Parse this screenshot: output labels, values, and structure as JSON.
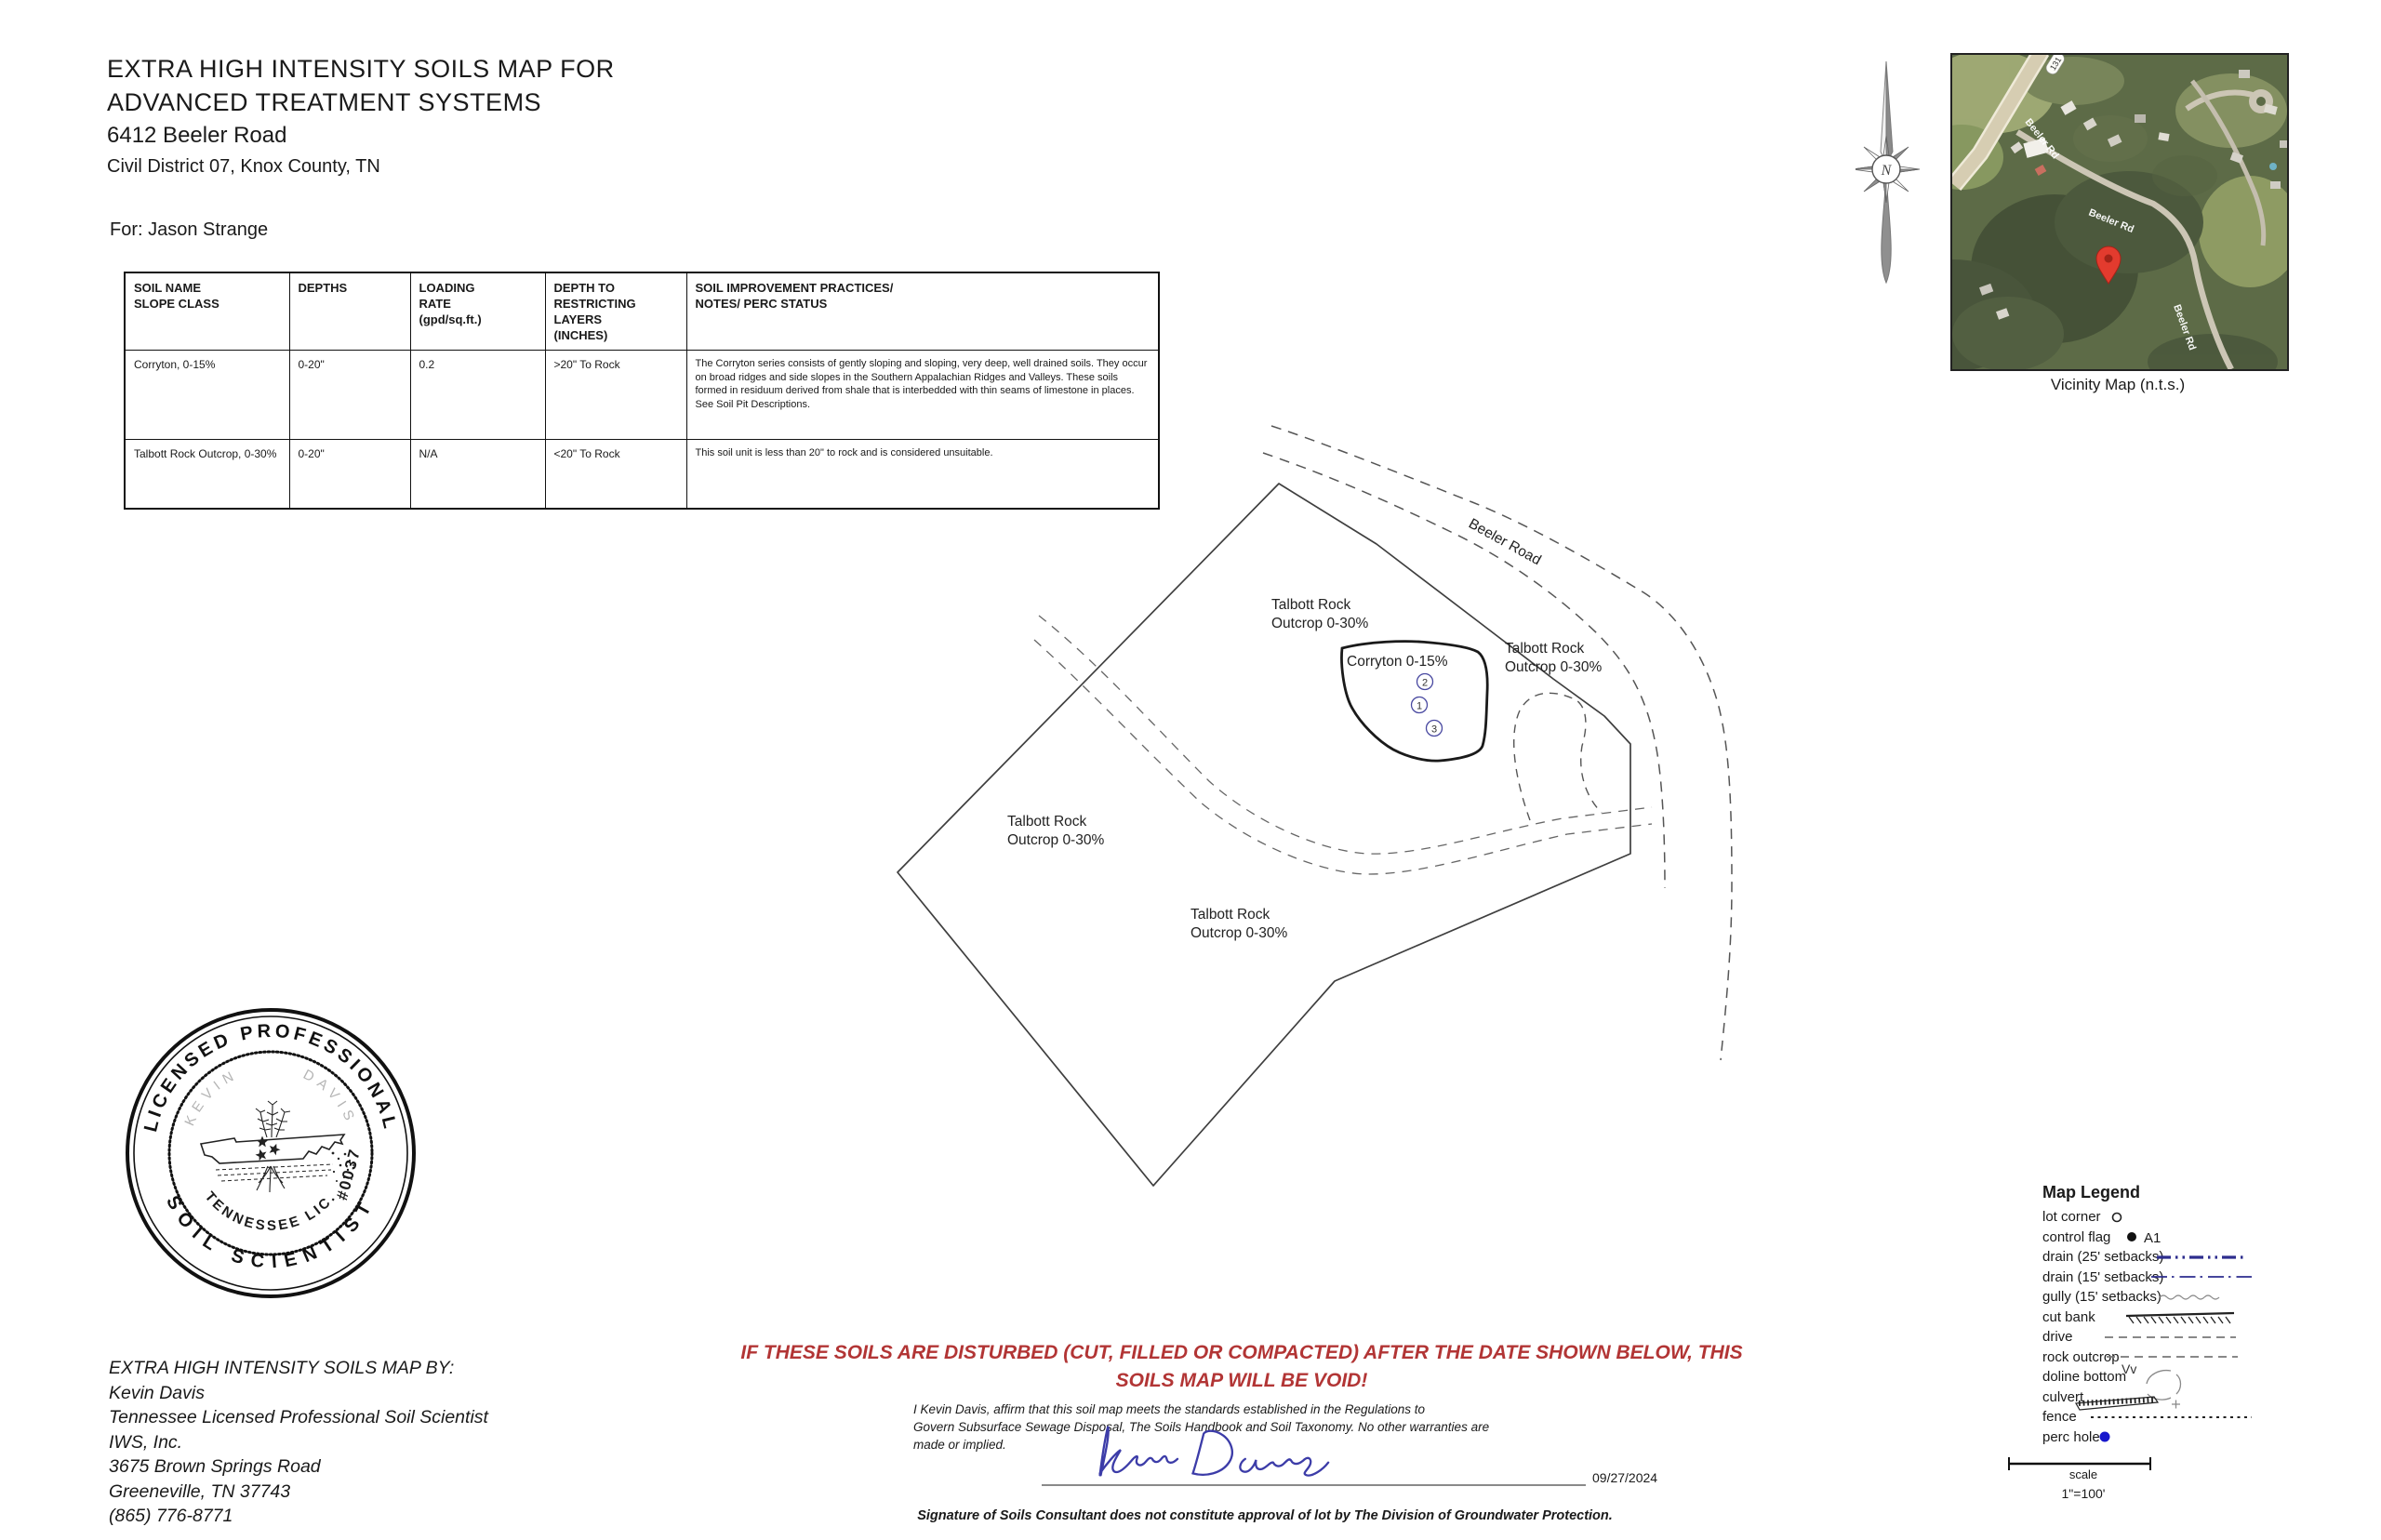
{
  "title": {
    "line1": "EXTRA HIGH INTENSITY SOILS MAP FOR",
    "line2": "ADVANCED TREATMENT SYSTEMS",
    "line3": "6412 Beeler Road",
    "line4": "Civil District 07, Knox County, TN",
    "for_line": "For:  Jason Strange"
  },
  "soil_table": {
    "headers": {
      "col1": [
        "SOIL NAME",
        "SLOPE CLASS"
      ],
      "col2": [
        "DEPTHS"
      ],
      "col3": [
        "LOADING",
        "RATE",
        "(gpd/sq.ft.)"
      ],
      "col4": [
        "DEPTH TO",
        "RESTRICTING",
        "LAYERS",
        "(INCHES)"
      ],
      "col5": [
        "SOIL IMPROVEMENT PRACTICES/",
        "NOTES/ PERC STATUS"
      ]
    },
    "rows": [
      {
        "name": "Corryton, 0-15%",
        "depths": "0-20\"",
        "rate": "0.2",
        "restricting": ">20\" To Rock",
        "notes": "The Corryton series consists of gently sloping and sloping, very deep, well drained soils. They occur on broad ridges and side slopes in the Southern Appalachian Ridges and Valleys. These soils formed in residuum derived from shale that is interbedded with thin seams of limestone in places. See Soil Pit Descriptions."
      },
      {
        "name": "Talbott Rock Outcrop, 0-30%",
        "depths": "0-20\"",
        "rate": "N/A",
        "restricting": "<20\" To Rock",
        "notes": "This soil unit is less than 20\" to rock and is considered unsuitable."
      }
    ]
  },
  "map": {
    "road_label": "Beeler Road",
    "corryton_label": "Corryton 0-15%",
    "talbott_line1": "Talbott Rock",
    "talbott_line2": "Outcrop 0-30%",
    "perc1": "2",
    "perc2": "1",
    "perc3": "3"
  },
  "vicinity": {
    "caption": "Vicinity Map (n.t.s.)",
    "road_label": "Beeler Rd",
    "route_shield": "131"
  },
  "compass": {
    "letter": "N"
  },
  "seal": {
    "arc_top": "LICENSED PROFESSIONAL",
    "arc_bottom": "SOIL SCIENTIST",
    "inner_left": "KEVIN",
    "inner_right": "DAVIS",
    "inner_bottom": "TENNESSEE LIC.",
    "license": "#0037"
  },
  "author_block": {
    "line1": "EXTRA HIGH INTENSITY SOILS MAP BY:",
    "line2": "Kevin Davis",
    "line3": "Tennessee Licensed Professional Soil Scientist",
    "line4": "IWS, Inc.",
    "line5": "3675 Brown Springs Road",
    "line6": "Greeneville, TN 37743",
    "line7": "(865)  776-8771"
  },
  "warning": {
    "line1": "IF THESE SOILS ARE DISTURBED (CUT, FILLED OR COMPACTED) AFTER THE DATE SHOWN BELOW, THIS",
    "line2": "SOILS MAP WILL BE VOID!"
  },
  "affirmation": {
    "line1": "I Kevin Davis, affirm that this soil map meets the standards established in the Regulations to",
    "line2": "Govern Subsurface Sewage Disposal, The Soils Handbook and Soil Taxonomy.  No other warranties are",
    "line3": "made or implied.",
    "signature_name": "Kevin Davis",
    "date": "09/27/2024",
    "disclaimer": "Signature of Soils Consultant does not constitute approval of lot by The Division of Groundwater Protection."
  },
  "legend": {
    "title": "Map Legend",
    "items": [
      {
        "label": "lot corner"
      },
      {
        "label": "control flag"
      },
      {
        "label": "drain (25' setbacks)"
      },
      {
        "label": "drain (15' setbacks)"
      },
      {
        "label": "gully  (15' setbacks)"
      },
      {
        "label": "cut bank"
      },
      {
        "label": "drive"
      },
      {
        "label": "rock outcrop"
      },
      {
        "label": "doline bottom"
      },
      {
        "label": "culvert"
      },
      {
        "label": "fence"
      },
      {
        "label": "perc hole"
      }
    ],
    "control_tag": "A1",
    "rock_symbol": "Vv",
    "scale_label": "scale",
    "scale_value": "1\"=100'"
  },
  "colors": {
    "warning_red": "#b23535",
    "drain_blue": "#2d2d8e",
    "perc_blue": "#1717cc",
    "pin_red": "#e33b2e",
    "signature_blue": "#3c3ca8"
  }
}
